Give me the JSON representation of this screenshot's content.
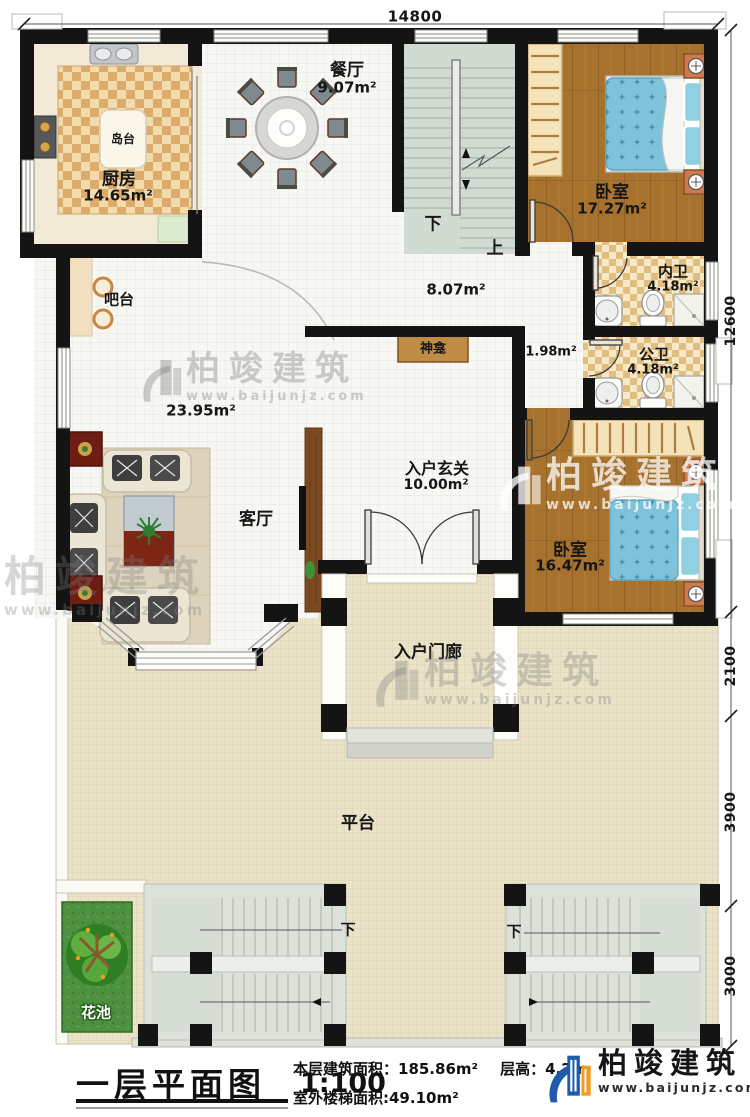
{
  "title_block": {
    "title": "一层平面图",
    "scale": "1:100",
    "floor_area": "本层建筑面积：185.86m²",
    "floor_height": "层高：4.2m",
    "outdoor_stair_area": "室外楼梯面积:49.10m²"
  },
  "logo": {
    "name": "柏竣建筑",
    "website": "www.baijunjz.com"
  },
  "watermark": {
    "name": "柏竣建筑",
    "website": "www.baijunjz.com"
  },
  "dimensions": {
    "top_width": "14800",
    "right": {
      "r1": "12600",
      "r2": "2100",
      "r3": "3900",
      "r4": "3000"
    }
  },
  "rooms": {
    "dining": {
      "name": "餐厅",
      "area": "9.07m²"
    },
    "kitchen": {
      "name": "厨房",
      "area": "14.65m²"
    },
    "island": {
      "name": "岛台"
    },
    "bar": {
      "name": "吧台"
    },
    "bedroom1": {
      "name": "卧室",
      "area": "17.27m²"
    },
    "ensuite_bath": {
      "name": "内卫",
      "area": "4.18m²"
    },
    "stair_hall": {
      "area": "8.07m²"
    },
    "public_bath": {
      "name": "公卫",
      "area": "4.18m²"
    },
    "corridor": {
      "area": "1.98m²"
    },
    "shrine": {
      "name": "神龛"
    },
    "living": {
      "name": "客厅",
      "area": "23.95m²"
    },
    "foyer": {
      "name": "入户玄关",
      "area": "10.00m²"
    },
    "bedroom2": {
      "name": "卧室",
      "area": "16.47m²"
    },
    "porch": {
      "name": "入户门廊"
    },
    "platform": {
      "name": "平台"
    },
    "flower_bed": {
      "name": "花池"
    }
  },
  "stair_labels": {
    "down": "下",
    "up": "上"
  },
  "colors": {
    "wall": "#141414",
    "wood_floor": "#a6722e",
    "tile_checker": "#ddab6c",
    "bath_checker": "#e2bd80",
    "bed_blue": "#7fc3da",
    "platform": "#ebe3c8",
    "stair_green": "#d2dbd1",
    "flower_green": "#4d9140",
    "logo_blue": "#1d5cab",
    "logo_orange": "#f6991d"
  }
}
